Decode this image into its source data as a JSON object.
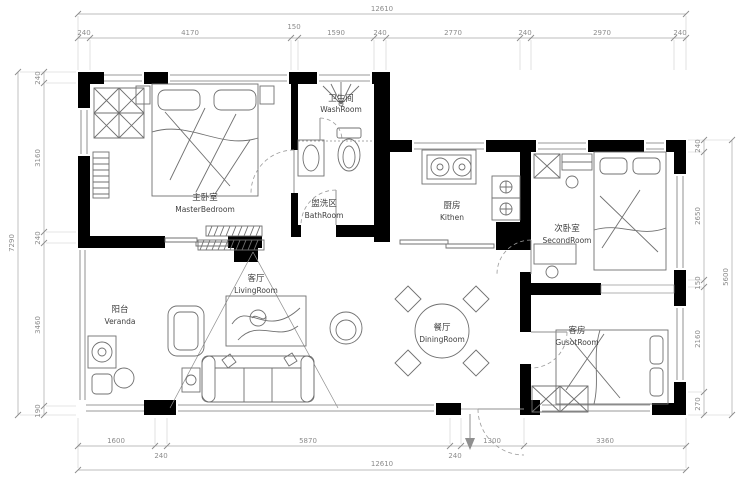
{
  "meta": {
    "type": "apartment-floor-plan",
    "width": 750,
    "height": 490
  },
  "colors": {
    "wall": "#000000",
    "dim_line": "#a6a6a6",
    "dim_text": "#8c8c8c",
    "furniture": "#707070",
    "label_text": "#3f3f3f",
    "door_arc": "#9a9a9a"
  },
  "rooms": {
    "master": {
      "zh": "主卧室",
      "en": "MasterBedroom"
    },
    "wash": {
      "zh": "卫生间",
      "en": "WashRoom"
    },
    "bath": {
      "zh": "盥洗区",
      "en": "BathRoom"
    },
    "kitchen": {
      "zh": "厨房",
      "en": "Kithen"
    },
    "second": {
      "zh": "次卧室",
      "en": "SecondRoom"
    },
    "living": {
      "zh": "客厅",
      "en": "LivingRoom"
    },
    "veranda": {
      "zh": "阳台",
      "en": "Veranda"
    },
    "dining": {
      "zh": "餐厅",
      "en": "DiningRoom"
    },
    "guest": {
      "zh": "客房",
      "en": "GusotRoom"
    }
  },
  "dimensions": {
    "top_total": "12610",
    "top_segments": [
      "240",
      "4170",
      "150",
      "1590",
      "240",
      "2770",
      "240",
      "2970",
      "240"
    ],
    "bottom_total": "12610",
    "bottom_segments": [
      "1600",
      "240",
      "5870",
      "240",
      "1300",
      "3360"
    ],
    "left_total": "7290",
    "left_segments": [
      "240",
      "3160",
      "240",
      "3460",
      "190"
    ],
    "right_total": "5600",
    "right_segments": [
      "240",
      "2650",
      "150",
      "2160",
      "270"
    ]
  }
}
